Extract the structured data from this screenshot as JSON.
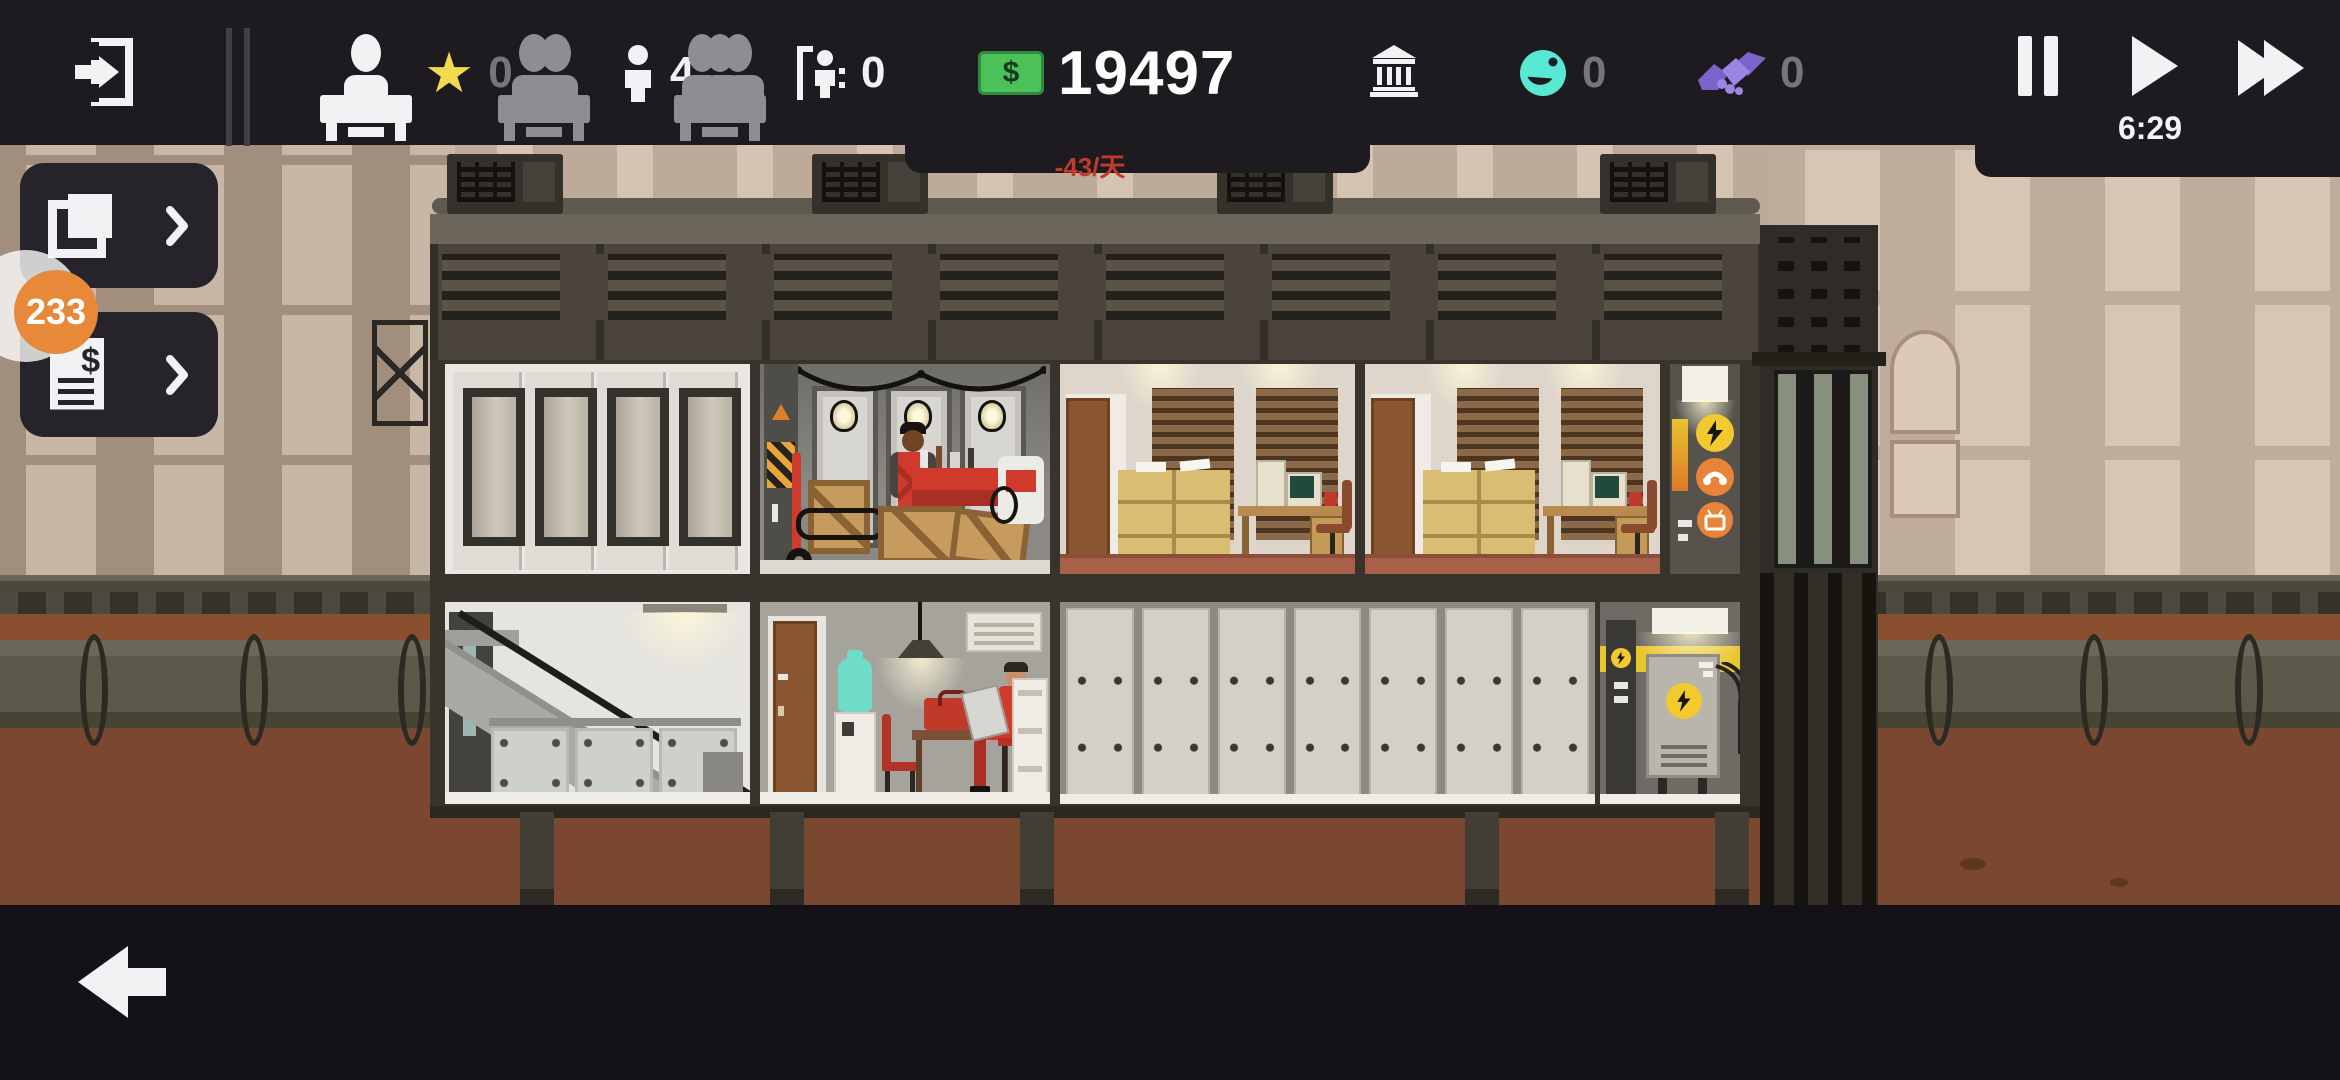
{
  "hud": {
    "clock": "6:29",
    "prestige": {
      "value": "0"
    },
    "workers": {
      "value": "4"
    },
    "visitors": {
      "value": "0"
    },
    "money": {
      "value": "19497",
      "per_day": "-43/天",
      "currency_symbol": "$"
    },
    "happiness": {
      "value": "0"
    },
    "contracts": {
      "value": "0"
    }
  },
  "side_panels": {
    "badge": "233"
  },
  "icons": {
    "top_left": "exit-door-icon",
    "stats": [
      "star-icon",
      "person-icon",
      "person-at-door-icon",
      "cash-icon",
      "bank-icon",
      "smiley-globe-icon",
      "handshake-icon"
    ],
    "time_controls": [
      "pause-icon",
      "play-icon",
      "fast-forward-icon"
    ],
    "side_buttons": [
      "blueprints-icon",
      "invoice-icon"
    ],
    "bottom_bar": [
      "back-arrow-icon",
      "desk-1-person-icon",
      "desk-2-people-icon",
      "desk-3-people-icon"
    ]
  },
  "colors": {
    "topbar_bg": "#1d1b20",
    "bottombar_bg": "#141218",
    "money_green": "#4cc15a",
    "per_day_red": "#c13a2c",
    "star_yellow": "#f2d94e",
    "happiness_teal": "#58e8d4",
    "contracts_purple": "#8d7ad9",
    "badge_orange": "#e8893a",
    "hazard_yellow": "#e8c62e",
    "dirt_brown": "#7a4730",
    "city_tan": "#b7a495"
  }
}
